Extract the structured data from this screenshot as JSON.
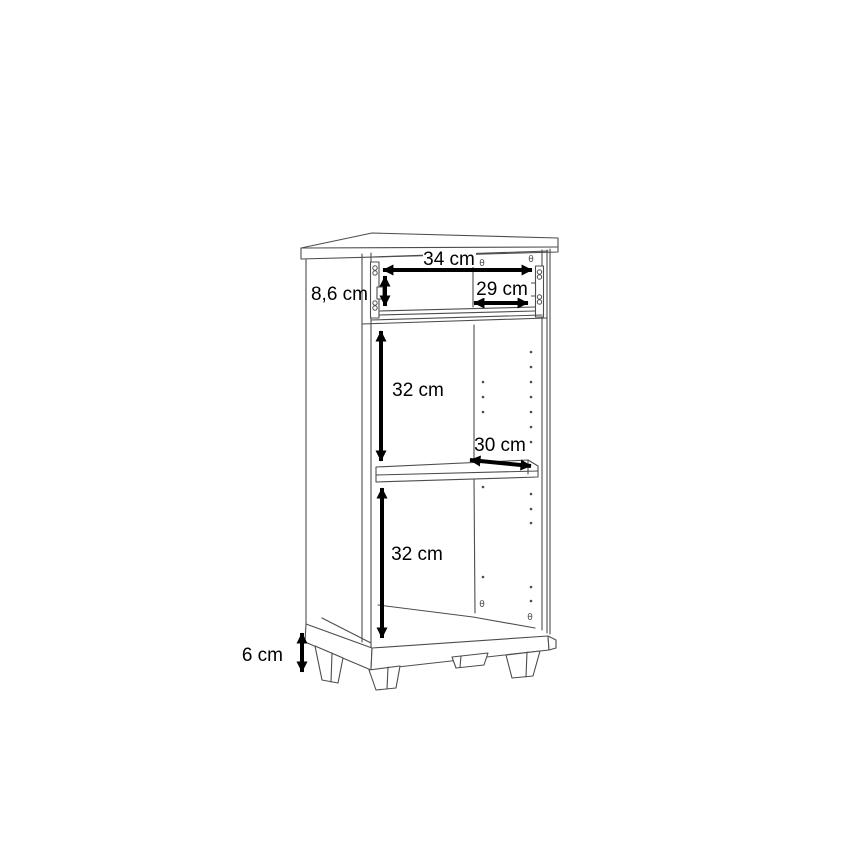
{
  "page": {
    "background": "#ffffff",
    "width": 868,
    "height": 868
  },
  "diagram": {
    "type": "furniture-dimension-drawing",
    "subject": "narrow cabinet carcass with drawer runners, middle shelf, plinth and four feet",
    "units": "cm",
    "line_color": "#4d4d4d",
    "dimension_color": "#000000",
    "dimensions": {
      "top_inner_width": {
        "label": "34 cm",
        "value": 34,
        "orientation": "horizontal"
      },
      "drawer_opening_height": {
        "label": "8,6 cm",
        "value": 8.6,
        "orientation": "vertical"
      },
      "drawer_inner_width": {
        "label": "29 cm",
        "value": 29,
        "orientation": "horizontal"
      },
      "upper_compartment_height": {
        "label": "32 cm",
        "value": 32,
        "orientation": "vertical"
      },
      "shelf_depth": {
        "label": "30 cm",
        "value": 30,
        "orientation": "diagonal"
      },
      "lower_compartment_height": {
        "label": "32 cm",
        "value": 32,
        "orientation": "vertical"
      },
      "feet_height": {
        "label": "6 cm",
        "value": 6,
        "orientation": "vertical"
      }
    }
  }
}
